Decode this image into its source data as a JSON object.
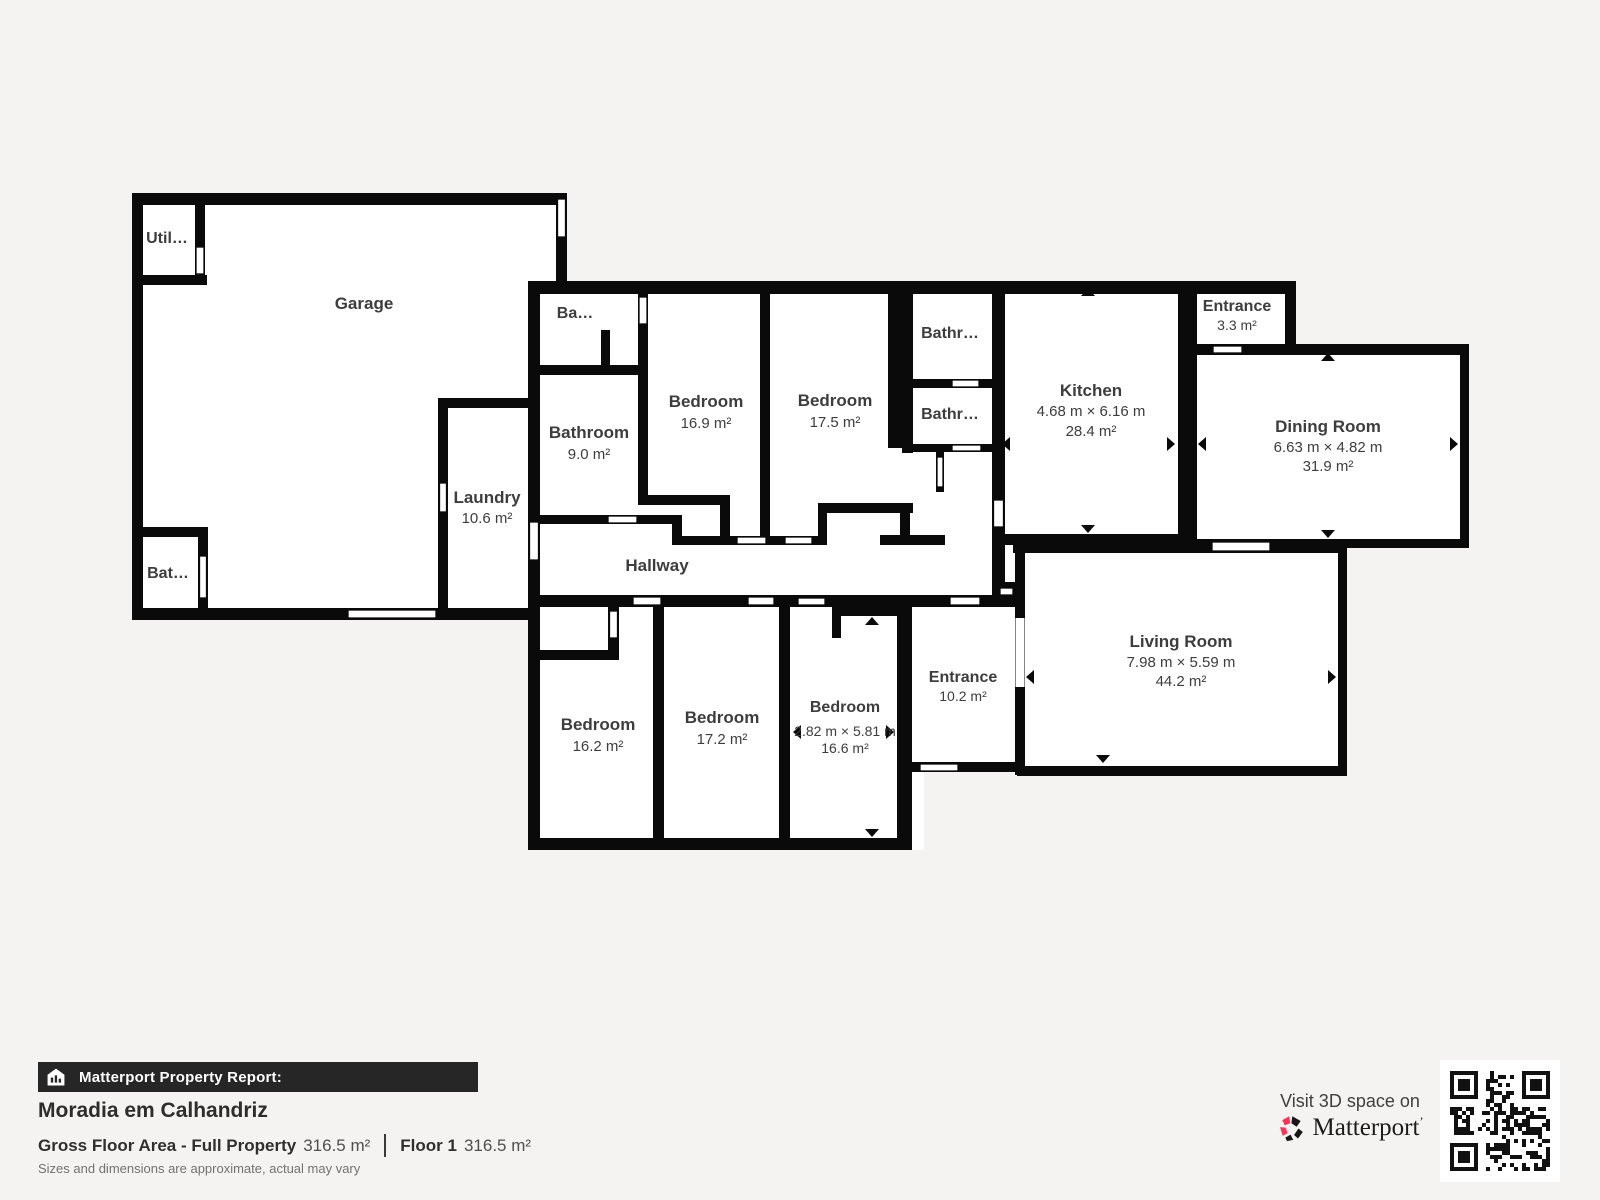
{
  "colors": {
    "wall": "#0a0a0a",
    "floor": "#ffffff",
    "background": "#f4f3f1",
    "label": "#3d3d3d",
    "footer_bar": "#262626",
    "brand_red": "#ff3158"
  },
  "rooms": {
    "utility": {
      "name": "Util…"
    },
    "garage": {
      "name": "Garage"
    },
    "bathroom_garage": {
      "name": "Bat…"
    },
    "laundry": {
      "name": "Laundry",
      "area": "10.6 m²"
    },
    "bathroom_top": {
      "name": "Ba…"
    },
    "bathroom_9": {
      "name": "Bathroom",
      "area": "9.0 m²"
    },
    "bedroom_169": {
      "name": "Bedroom",
      "area": "16.9 m²"
    },
    "bedroom_175": {
      "name": "Bedroom",
      "area": "17.5 m²"
    },
    "bathroom_1": {
      "name": "Bathr…"
    },
    "bathroom_2": {
      "name": "Bathr…"
    },
    "kitchen": {
      "name": "Kitchen",
      "dims": "4.68 m × 6.16 m",
      "area": "28.4 m²"
    },
    "entrance_small": {
      "name": "Entrance",
      "area": "3.3 m²"
    },
    "dining": {
      "name": "Dining Room",
      "dims": "6.63 m × 4.82 m",
      "area": "31.9 m²"
    },
    "hallway": {
      "name": "Hallway"
    },
    "living": {
      "name": "Living Room",
      "dims": "7.98 m × 5.59 m",
      "area": "44.2 m²"
    },
    "entrance_main": {
      "name": "Entrance",
      "area": "10.2 m²"
    },
    "bedroom_162": {
      "name": "Bedroom",
      "area": "16.2 m²"
    },
    "bedroom_172": {
      "name": "Bedroom",
      "area": "17.2 m²"
    },
    "bedroom_166": {
      "name": "Bedroom",
      "dims": "2.82 m × 5.81 m",
      "area": "16.6 m²"
    }
  },
  "footer": {
    "report_label": "Matterport Property Report:",
    "property_name": "Moradia em Calhandriz",
    "gross_label": "Gross Floor Area - Full Property",
    "gross_value": "316.5 m²",
    "floor_label": "Floor 1",
    "floor_value": "316.5 m²",
    "disclaimer": "Sizes and dimensions are approximate, actual may vary",
    "visit_text": "Visit 3D space on",
    "brand": "Matterport",
    "brand_mark": "’"
  }
}
